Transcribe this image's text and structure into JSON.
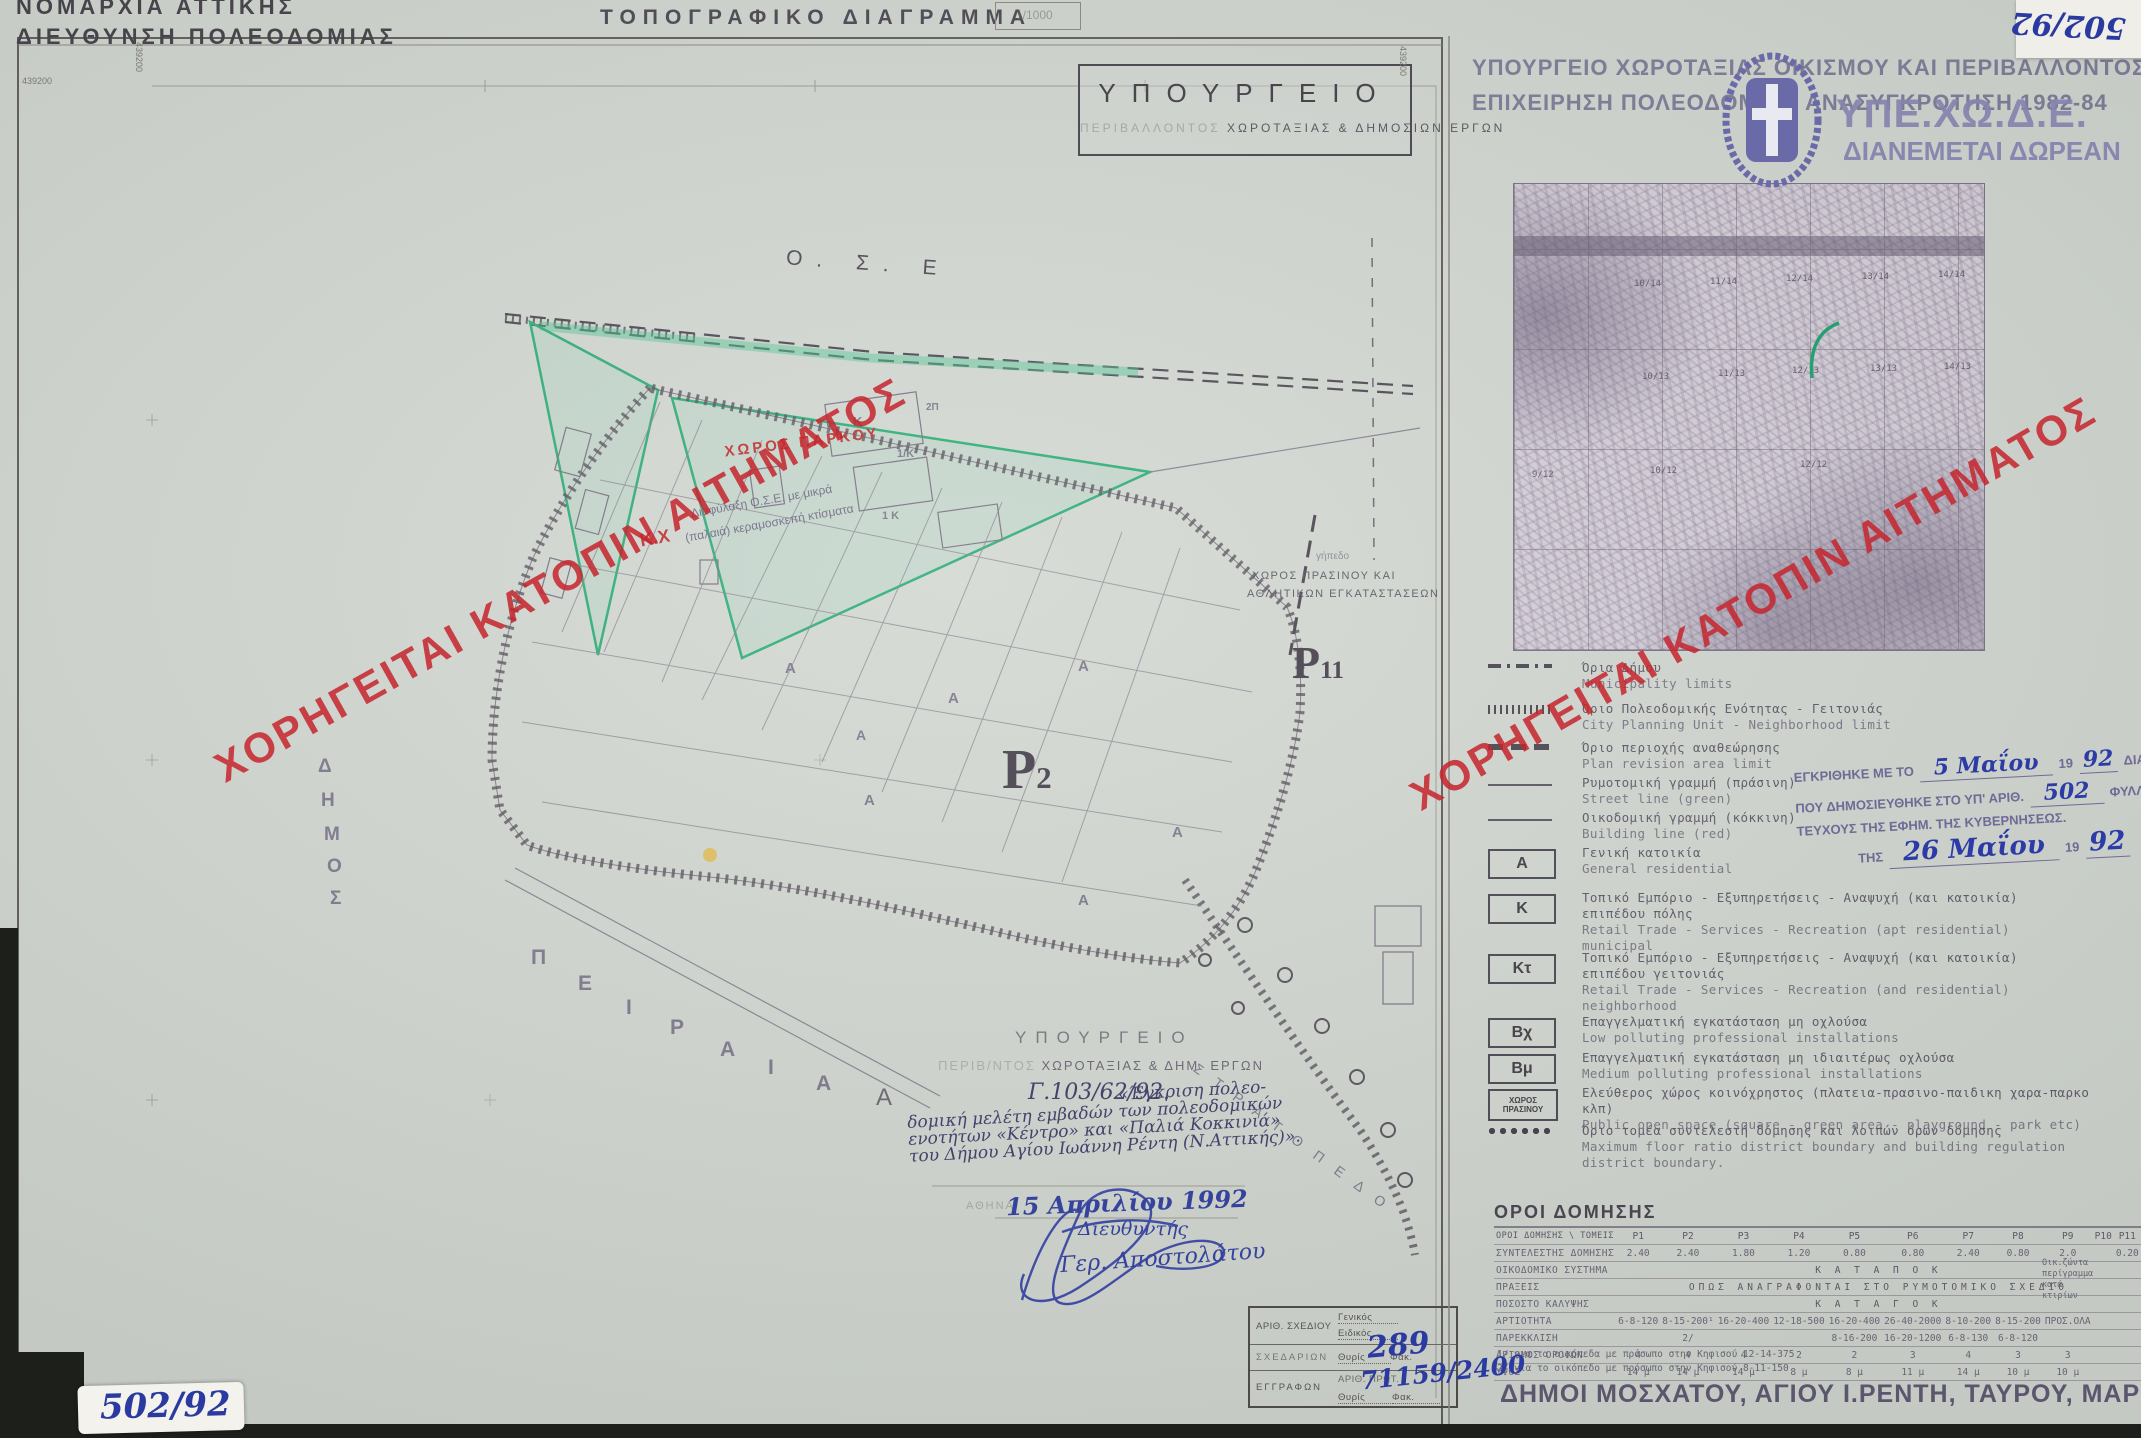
{
  "doc": {
    "sheet_no_top": "502/92",
    "sheet_no_bottom": "502/92",
    "scale": "1/1000"
  },
  "header_left": {
    "line1": "ΝΟΜΑΡΧΙΑ  ΑΤΤΙΚΗΣ",
    "line2": "ΔΙΕΥΘΥΝΣΗ ΠΟΛΕΟΔΟΜΙΑΣ"
  },
  "title": "ΤΟΠΟΓΡΑΦΙΚΟ  ΔΙΑΓΡΑΜΜΑ",
  "ministry_box": {
    "line1": "ΥΠΟΥΡΓΕΙΟ",
    "line2_faded": "ΠΕΡΙΒΑΛΛΟΝΤΟΣ",
    "line2": "ΧΩΡΟΤΑΞΙΑΣ  &  ΔΗΜΟΣΙΩΝ  ΕΡΓΩΝ"
  },
  "right_header": {
    "line1": "ΥΠΟΥΡΓΕΙΟ ΧΩΡΟΤΑΞΙΑΣ ΟΙΚΙΣΜΟΥ ΚΑΙ ΠΕΡΙΒΑΛΛΟΝΤΟΣ",
    "line2": "ΕΠΙΧΕΙΡΗΣΗ ΠΟΛΕΟΔΟΜΙΚΗ ΑΝΑΣΥΓΚΡΟΤΗΣΗ 1982-84",
    "brand": "ΥΠΕ.ΧΩ.Δ.Ε.",
    "brand_sub": "ΔΙΑΝΕΜΕΤΑΙ ΔΩΡΕΑΝ"
  },
  "watermark": "ΧΟΡΗΓΕΙΤΑΙ ΚΑΤΟΠΙΝ ΑΙΤΗΜΑΤΟΣ",
  "frame": {
    "coord_topleft": "439200",
    "coord_left_vert": "439200",
    "coord_right_vert": "439200"
  },
  "map_texts": {
    "ose": "Ο. Σ. Ε",
    "park": "ΧΩΡΟΣ ΠΑΡΚΟΥ",
    "kx": "Κ.Χ",
    "note1": "Διαφύλαξη Ο.Σ.Ε. με μικρά",
    "note2": "(παλαιά) κεραμοσκεπή κτίσματα",
    "green1": "ΧΩΡΟΣ ΠΡΑΣΙΝΟΥ ΚΑΙ",
    "green2": "ΑΘΛΗΤΙΚΩΝ ΕΓΚΑΤΑΣΤΑΣΕΩΝ",
    "gipedo": "γήπεδο",
    "p_letter": "Ρ",
    "p2_sub": "2",
    "p11_sub": "11",
    "stratopedo": "Σ Τ Ρ Α Τ Ο Π Ε Δ Ο",
    "a_margin": "Α"
  },
  "dimos_letters": [
    {
      "ch": "Δ",
      "x": 318,
      "y": 756
    },
    {
      "ch": "Η",
      "x": 321,
      "y": 790
    },
    {
      "ch": "Μ",
      "x": 324,
      "y": 824
    },
    {
      "ch": "Ο",
      "x": 327,
      "y": 856
    },
    {
      "ch": "Σ",
      "x": 330,
      "y": 888
    }
  ],
  "piraeus_letters": [
    {
      "ch": "Π",
      "x": 531,
      "y": 946
    },
    {
      "ch": "Ε",
      "x": 578,
      "y": 972
    },
    {
      "ch": "Ι",
      "x": 626,
      "y": 996
    },
    {
      "ch": "Ρ",
      "x": 670,
      "y": 1016
    },
    {
      "ch": "Α",
      "x": 720,
      "y": 1038
    },
    {
      "ch": "Ι",
      "x": 768,
      "y": 1056
    },
    {
      "ch": "Α",
      "x": 816,
      "y": 1072
    }
  ],
  "block_letters": [
    {
      "ch": "Α",
      "x": 785,
      "y": 660,
      "fs": 15
    },
    {
      "ch": "Α",
      "x": 948,
      "y": 690,
      "fs": 15
    },
    {
      "ch": "Α",
      "x": 1078,
      "y": 658,
      "fs": 15
    },
    {
      "ch": "Α",
      "x": 864,
      "y": 792,
      "fs": 15
    },
    {
      "ch": "Α",
      "x": 1172,
      "y": 824,
      "fs": 15
    },
    {
      "ch": "Α",
      "x": 1078,
      "y": 892,
      "fs": 15
    },
    {
      "ch": "Α",
      "x": 856,
      "y": 727,
      "fs": 14
    },
    {
      "ch": "Κ",
      "x": 853,
      "y": 414,
      "fs": 13
    },
    {
      "ch": "1/Κ",
      "x": 897,
      "y": 448,
      "fs": 11
    },
    {
      "ch": "1 Κ",
      "x": 882,
      "y": 510,
      "fs": 11
    },
    {
      "ch": "2Π",
      "x": 926,
      "y": 402,
      "fs": 10
    }
  ],
  "stamp2": {
    "line1": "ΥΠΟΥΡΓΕΙΟ",
    "line2_faded": "ΠΕΡΙΒ/ΝΤΟΣ",
    "line2": "ΧΩΡΟΤΑΞΙΑΣ & ΔΗΜ. ΕΡΓΩΝ",
    "protocol": "Γ.103/62/92."
  },
  "note": {
    "l1": "«Έγκριση πολεο-",
    "l2": "δομική μελέτη εμβαδών των πολεοδομικών",
    "l3": "ενοτήτων «Κέντρο» και «Παλιά Κοκκινιά»",
    "l4": "του Δήμου Αγίου Ιωάννη Ρέντη (Ν.Αττικής)»."
  },
  "dateline": {
    "city": "ΑΘΗΝΑ",
    "date_hand": "15 Απριλίου 1992",
    "role_hand": "Διευθυντής",
    "name_hand": "Γερ. Αποστολάτου"
  },
  "drawing_box": {
    "r1": "ΑΡΙΘ. ΣΧΕΔΙΟΥ",
    "r1a": "Γενικός",
    "r1b": "Ειδικός",
    "r2": "ΣΧΕΔΑΡΙΩΝ",
    "r2a": "Θυρίς",
    "r2b": "Φακ.",
    "r2_hand": "289",
    "r3": "ΕΓΓΡΑΦΩΝ",
    "r3a": "ΑΡΙΘ. ΠΡΩΤ.",
    "r3_hand": "71159/2400",
    "r3b": "Θυρίς",
    "r3c": "Φακ."
  },
  "inset_labels": [
    {
      "t": "10/14",
      "x": 120,
      "y": 95
    },
    {
      "t": "11/14",
      "x": 196,
      "y": 93
    },
    {
      "t": "12/14",
      "x": 272,
      "y": 90
    },
    {
      "t": "13/14",
      "x": 348,
      "y": 88
    },
    {
      "t": "14/14",
      "x": 424,
      "y": 86
    },
    {
      "t": "10/13",
      "x": 128,
      "y": 188
    },
    {
      "t": "11/13",
      "x": 204,
      "y": 185
    },
    {
      "t": "12/13",
      "x": 278,
      "y": 182
    },
    {
      "t": "13/13",
      "x": 356,
      "y": 180
    },
    {
      "t": "14/13",
      "x": 430,
      "y": 178
    },
    {
      "t": "9/12",
      "x": 18,
      "y": 286
    },
    {
      "t": "10/12",
      "x": 136,
      "y": 282
    },
    {
      "t": "12/12",
      "x": 286,
      "y": 276
    }
  ],
  "legend": {
    "items": [
      {
        "sym": "dashdot",
        "y": 660,
        "gr": "Όρια Δήμου",
        "en": "Municipality limits"
      },
      {
        "sym": "hatch",
        "y": 701,
        "gr": "Όριο Πολεοδομικής Ενότητας - Γειτονιάς",
        "en": "City Planning Unit - Neighborhood limit"
      },
      {
        "sym": "bolddash",
        "y": 740,
        "gr": "Όριο περιοχής αναθεώρησης",
        "en": "Plan revision area limit"
      },
      {
        "sym": "line",
        "y": 775,
        "gr": "Ρυμοτομική γραμμή (πράσινη)",
        "en": "Street line (green)"
      },
      {
        "sym": "line",
        "y": 810,
        "gr": "Οικοδομική γραμμή (κόκκινη)",
        "en": "Building line (red)"
      },
      {
        "sym": "box",
        "key": "Α",
        "y": 845,
        "gr": "Γενική κατοικία",
        "en": "General residential"
      },
      {
        "sym": "box",
        "key": "Κ",
        "y": 890,
        "gr": "Τοπικό Εμπόριο - Εξυπηρετήσεις - Αναψυχή (και κατοικία)",
        "gr2": "επιπέδου πόλης",
        "en": "Retail Trade - Services - Recreation (apt residential)",
        "en2": "municipal"
      },
      {
        "sym": "box",
        "key": "Κτ",
        "y": 950,
        "gr": "Τοπικό Εμπόριο - Εξυπηρετήσεις - Αναψυχή (και κατοικία)",
        "gr2": "επιπέδου γειτονιάς",
        "en": "Retail Trade - Services - Recreation (and residential)",
        "en2": "neighborhood"
      },
      {
        "sym": "box",
        "key": "Βχ",
        "y": 1014,
        "gr": "Επαγγελματική εγκατάσταση μη οχλούσα",
        "en": "Low polluting professional installations"
      },
      {
        "sym": "box",
        "key": "Βμ",
        "y": 1050,
        "gr": "Επαγγελματική εγκατάσταση μη ιδιαιτέρως οχλούσα",
        "en": "Medium polluting professional installations"
      },
      {
        "sym": "boxsm",
        "key": "ΧΩΡΟΣ ΠΡΑΣΙΝΟΥ",
        "y": 1085,
        "gr": "Ελεύθερος χώρος κοινόχρηστος (πλατεια-πρασινο-παιδικη χαρα-παρκο κλπ)",
        "en": "Public open space (square - green area - playground - park etc)"
      },
      {
        "sym": "dots",
        "y": 1123,
        "gr": "Όριο τομέα συντελεστή δόμησης και λοιπών όρων δόμησης",
        "en": "Maximum floor ratio district boundary and building regulation district boundary."
      }
    ]
  },
  "approval": {
    "l1a": "ΕΓΚΡΙΘΗΚΕ ΜΕ ΤΟ",
    "l1_hand": "5 Μαΐου",
    "l1b": "19",
    "l1_hand2": "92",
    "l1c": "ΔΙΑΤΑΓΜΑ",
    "l2a": "ΠΟΥ ΔΗΜΟΣΙΕΥΘΗΚΕ ΣΤΟ ΥΠ' ΑΡΙΘ.",
    "l2_hand": "502",
    "l2b": "ΦΥΛΛΟ ΤΟΥ Δ'",
    "l3": "ΤΕΥΧΟΥΣ ΤΗΣ ΕΦΗΜ. ΤΗΣ ΚΥΒΕΡΝΗΣΕΩΣ.",
    "l4a": "ΤΗΣ",
    "l4_hand": "26 Μαΐου",
    "l4b": "19",
    "l4_hand2": "92"
  },
  "oroi": {
    "title": "ΟΡΟΙ ΔΟΜΗΣΗΣ",
    "corner": "ΟΡΟΙ ΔΟΜΗΣΗΣ \\ ΤΟΜΕΙΣ",
    "cols": [
      "Ρ1",
      "Ρ2",
      "Ρ3",
      "Ρ4",
      "Ρ5",
      "Ρ6",
      "Ρ7",
      "Ρ8",
      "Ρ9",
      "Ρ10",
      "Ρ11"
    ],
    "rows": [
      {
        "label": "ΣΥΝΤΕΛΕΣΤΗΣ ΔΟΜΗΣΗΣ",
        "cells": [
          "2.40",
          "2.40",
          "1.80",
          "1.20",
          "0.80",
          "0.80",
          "2.40",
          "0.80",
          "2.0",
          "",
          "0.20"
        ]
      },
      {
        "label": "ΟΙΚΟΔΟΜΙΚΟ ΣΥΣΤΗΜΑ",
        "span": "Κ Α Τ Α   Π Ο Κ"
      },
      {
        "label": "ΠΡΑΞΕΙΣ",
        "span": "ΟΠΩΣ  ΑΝΑΓΡΑΦΟΝΤΑΙ  ΣΤΟ  ΡΥΜΟΤΟΜΙΚΟ  ΣΧΕΔΙΟ"
      },
      {
        "label": "ΠΟΣΟΣΤΟ ΚΑΛΥΨΗΣ",
        "span": "Κ Α Τ Α   Γ Ο Κ"
      },
      {
        "label": "ΑΡΤΙΟΤΗΤΑ",
        "cells": [
          "6-8-120",
          "8-15-200¹",
          "16-20-400",
          "12-18-500",
          "16-20-400",
          "26-40-2000",
          "8-10-200",
          "8-15-200",
          "ΠΡΟΣ.ΟΛΑ",
          "",
          ""
        ]
      },
      {
        "label": "ΠΑΡΕΚΚΛΙΣΗ",
        "cells": [
          "",
          "2/",
          "",
          "",
          "8-16-200",
          "16-20-1200",
          "6-8-130",
          "6-8-120",
          "",
          "",
          ""
        ]
      },
      {
        "label": "ΑΡΙΘΜΟΣ ΟΡΟΦΩΝ",
        "cells": [
          "4",
          "4",
          "4",
          "2",
          "2",
          "3",
          "4",
          "3",
          "3",
          "",
          ""
        ]
      },
      {
        "label": "ΥΨΟΣ",
        "cells": [
          "14 μ",
          "14 μ",
          "14 μ",
          "8 μ",
          "8 μ",
          "11 μ",
          "14 μ",
          "10 μ",
          "10 μ",
          "",
          ""
        ]
      }
    ],
    "p10_notes": [
      "Οικ.ζώντα",
      "περίγραμμα",
      "κατά",
      "κτιρίων"
    ],
    "footnotes": [
      "1/ για τα οικόπεδα με πρόσωπο στην Κηφισού  12-14-375",
      "2/ για το οικόπεδο με πρόσωπο στην Κηφισού  8-11-150"
    ]
  },
  "municipalities": {
    "main": "ΔΗΜΟΙ  ΜΟΣΧΑΤΟΥ,  ΑΓΙΟΥ Ι.ΡΕΝΤΗ,  ΤΑΥΡΟΥ,  ΜΑΡΚΟΝΙ",
    "paren": "(Δ. ΑΘΗΝΑΙΩΝ)"
  }
}
